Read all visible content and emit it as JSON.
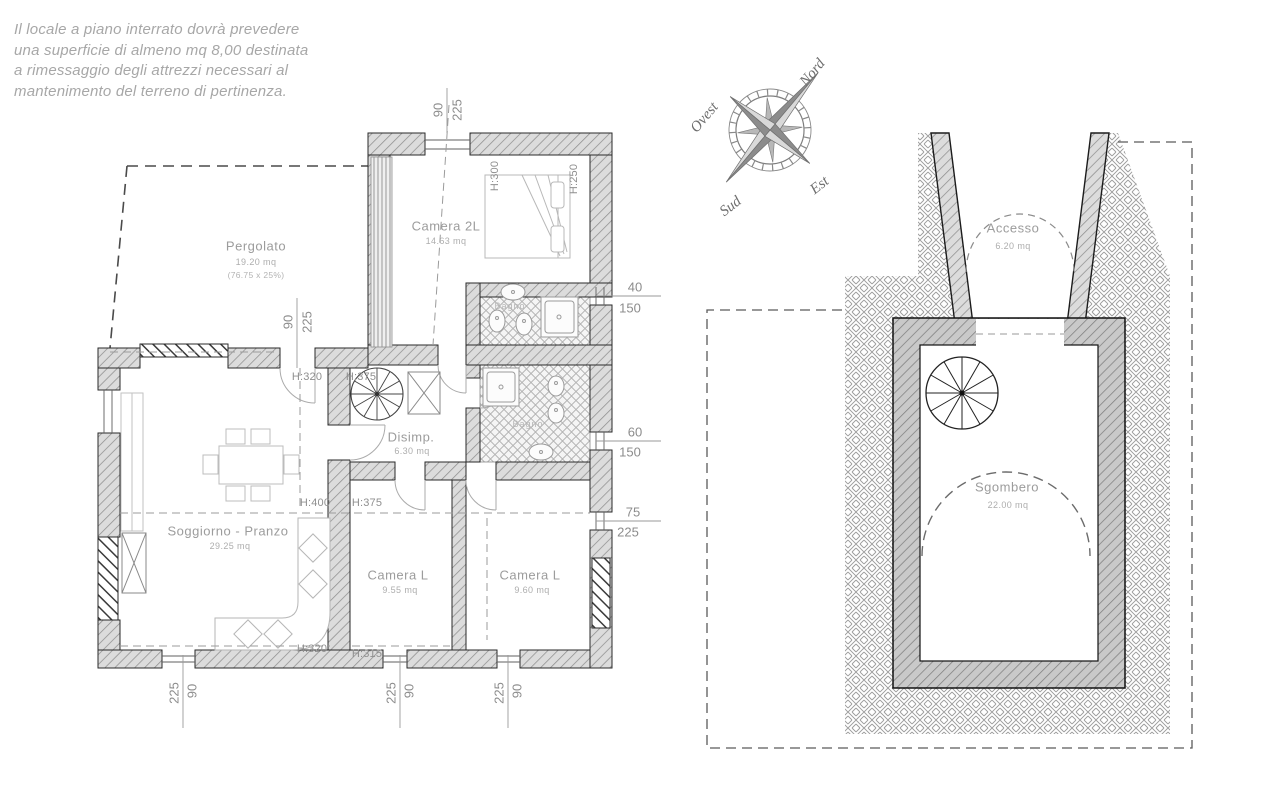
{
  "note": {
    "line1": "Il locale a piano interrato dovrà prevedere",
    "line2": "una superficie di almeno mq 8,00 destinata",
    "line3": "a rimessaggio degli attrezzi necessari al",
    "line4": "mantenimento del terreno di pertinenza."
  },
  "compass": {
    "north": "Nord",
    "east": "Est",
    "south": "Sud",
    "west": "Ovest"
  },
  "ground_floor": {
    "rooms": {
      "pergolato": {
        "name": "Pergolato",
        "area": "19.20 mq",
        "note": "(76.75 x 25%)"
      },
      "camera_2l": {
        "name": "Camera 2L",
        "area": "14.63 mq"
      },
      "bagno_1": {
        "name": "Bagno"
      },
      "bagno_2": {
        "name": "Bagno"
      },
      "disimpegno": {
        "name": "Disimp.",
        "area": "6.30 mq"
      },
      "soggiorno_pranzo": {
        "name": "Soggiorno - Pranzo",
        "area": "29.25 mq"
      },
      "camera_l_1": {
        "name": "Camera L",
        "area": "9.55 mq"
      },
      "camera_l_2": {
        "name": "Camera L",
        "area": "9.60 mq"
      }
    },
    "ceiling_heights": {
      "h320": "H:320",
      "h375": "H:375",
      "h400": "H:400",
      "h315": "H:315",
      "h300": "H:300",
      "h250": "H:250"
    },
    "dimensions": {
      "top": {
        "a": "90",
        "b": "225"
      },
      "west": {
        "a": "90",
        "b": "225"
      },
      "east_1": {
        "a": "40",
        "b": "150"
      },
      "east_2": {
        "a": "60",
        "b": "150"
      },
      "east_3": {
        "a": "75",
        "b": "225"
      },
      "south_1": {
        "a": "225",
        "b": "90"
      },
      "south_2": {
        "a": "225",
        "b": "90"
      },
      "south_3": {
        "a": "225",
        "b": "90"
      }
    }
  },
  "basement": {
    "rooms": {
      "accesso": {
        "name": "Accesso",
        "area": "6.20 mq"
      },
      "sgombero": {
        "name": "Sgombero",
        "area": "22.00 mq"
      }
    }
  }
}
